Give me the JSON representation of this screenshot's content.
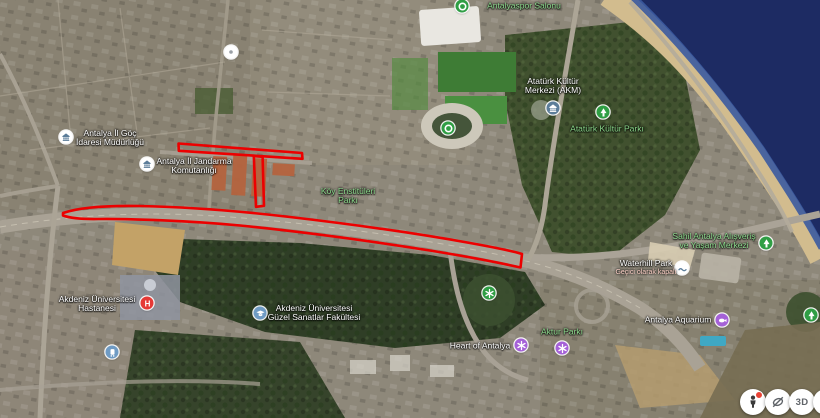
{
  "app": {
    "view": "satellite-map",
    "location": "Antalya"
  },
  "map": {
    "pois": [
      {
        "name": "antalya-il-goc-idaresi-mudurlugu",
        "lines": [
          "Antalya İl Göç",
          "İdaresi Müdürlüğü"
        ],
        "label_style": "white",
        "icon": "government-building"
      },
      {
        "name": "antalya-il-jandarma-komutanligi",
        "lines": [
          "Antalya İl Jandarma",
          "Komutanlığı"
        ],
        "label_style": "white",
        "icon": "government-building"
      },
      {
        "name": "antalyaspor-salonu",
        "lines": [
          "Antalyaspor Salonu"
        ],
        "label_style": "green",
        "icon": "sports-venue"
      },
      {
        "name": "ataturk-kultur-merkezi-akm",
        "lines": [
          "Atatürk Kültür",
          "Merkezi (AKM)"
        ],
        "label_style": "white",
        "icon": "culture-building"
      },
      {
        "name": "ataturk-kultur-parki",
        "lines": [
          "Atatürk Kültür Parkı"
        ],
        "label_style": "green",
        "icon": "park-tree"
      },
      {
        "name": "koy-enstituleri-parki",
        "lines": [
          "Köy Enstitüleri",
          "Parkı"
        ],
        "label_style": "green",
        "icon": "none"
      },
      {
        "name": "sahil-antalya-avm",
        "lines": [
          "Sahil Antalya Alışveriş",
          "ve Yaşam Merkezi"
        ],
        "label_style": "green",
        "icon": "park-tree"
      },
      {
        "name": "waterhill-park",
        "lines": [
          "Waterhill Park"
        ],
        "sublabel": "Geçici olarak kapalı",
        "label_style": "white",
        "icon": "waterpark"
      },
      {
        "name": "akdeniz-universitesi-hastanesi",
        "lines": [
          "Akdeniz Üniversitesi",
          "Hastanesi"
        ],
        "label_style": "white",
        "icon": "hospital"
      },
      {
        "name": "akdeniz-universitesi-guzel-sanatlar-fakultesi",
        "lines": [
          "Akdeniz Üniversitesi",
          "Güzel Sanatlar Fakültesi"
        ],
        "label_style": "white",
        "icon": "university"
      },
      {
        "name": "heart-of-antalya",
        "lines": [
          "Heart of Antalya"
        ],
        "label_style": "white",
        "icon": "attraction"
      },
      {
        "name": "aktur-parki",
        "lines": [
          "Aktur Parkı"
        ],
        "label_style": "green",
        "icon": "attraction"
      },
      {
        "name": "antalya-aquarium",
        "lines": [
          "Antalya Aquarium"
        ],
        "label_style": "white",
        "icon": "aquarium"
      }
    ]
  },
  "annotations": {
    "color": "#ec0000",
    "stroke_width": 2.6,
    "paths": [
      {
        "name": "route-outline-main-boulevard",
        "d": "M63,213 C80,207 110,205.5 140,206 C180,206.8 230,210 290,217 C350,224 420,234 470,243 C495,247.5 512,251 522,254 L520.5,267.5 C505,264 470,257 430,250.5 C370,241 300,231.5 240,225.5 C190,220.8 130,218.6 98,219 C80,219.3 70,218 63,215.5 Z"
      },
      {
        "name": "route-outline-north-segment",
        "d": "M178.5,143.5 L302,153 L302.5,158.8 L178.8,150.8 Z"
      },
      {
        "name": "route-outline-connector-segment",
        "d": "M253.8,156 L262.6,156.8 L264,205.8 L256,206.8 Z"
      }
    ]
  },
  "icons": {
    "hospital_glyph": "H"
  },
  "controls": {
    "buttons": [
      "street-view-pegman",
      "reset-tilt",
      "3d-view"
    ],
    "three_d_label": "3D"
  },
  "colors": {
    "annotation": "#ec0000",
    "label_white": "#ffffff",
    "label_green": "#8cd98c",
    "label_closed": "#ffd3c9",
    "poi_green": "#2f9e44",
    "poi_purple": "#a561d8",
    "poi_slate": "#5c7d99",
    "poi_red": "#e53935",
    "poi_blue": "#6f9bc4",
    "sea_deep": "#1d2b63",
    "beach_sand": "#d2bc8e"
  }
}
